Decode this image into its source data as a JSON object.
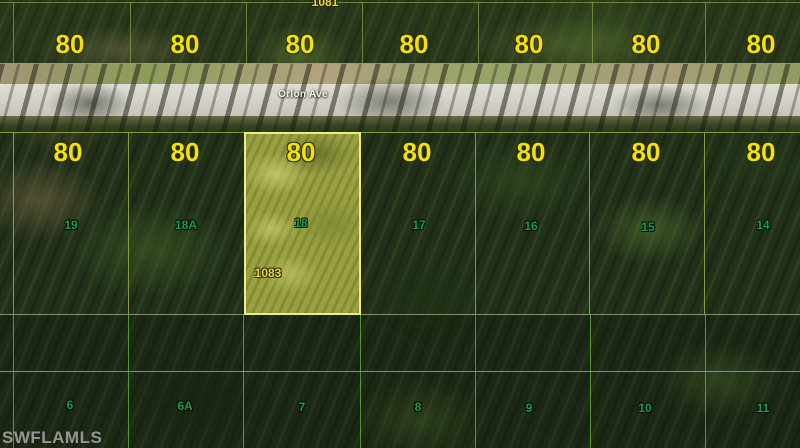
{
  "map": {
    "street_label": "Orlon Ave",
    "watermark": "SWFLAMLS",
    "parcel_above_number": "1081",
    "highlighted_parcel": {
      "lot": "18",
      "parcel_number": "1083",
      "width_label": "80"
    },
    "top_row_widths": [
      "80",
      "80",
      "80",
      "80",
      "80",
      "80",
      "80"
    ],
    "middle_row_widths": [
      "80",
      "80",
      "80",
      "80",
      "80",
      "80",
      "80"
    ],
    "middle_row_lots": [
      "19",
      "18A",
      "18",
      "17",
      "16",
      "15",
      "14"
    ],
    "bottom_row_lots": [
      "6",
      "6A",
      "7",
      "8",
      "9",
      "10",
      "11"
    ],
    "colors": {
      "width_label": "#f2e10e",
      "lot_label": "#16a24a",
      "parcel_number_label": "#e6d53e",
      "parcel_line_olive": "#96aa48",
      "parcel_line_bright": "#64c83e",
      "highlight_fill": "#9aa040",
      "highlight_border": "#f0f08c",
      "road_pavement": "#d6d4ca",
      "watermark_gray": "#b2b2b2"
    }
  }
}
